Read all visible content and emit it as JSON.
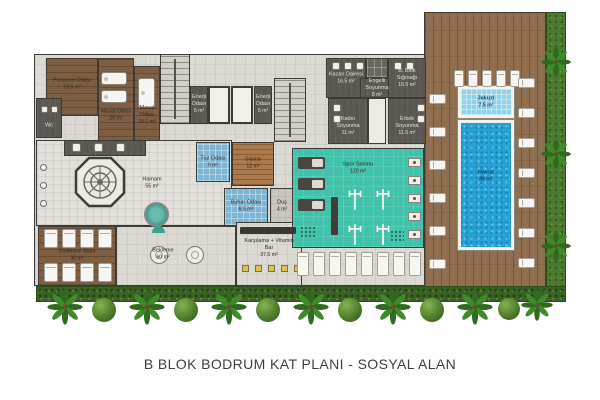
{
  "title": "B BLOK BODRUM KAT PLANI - SOSYAL ALAN",
  "colors": {
    "wall": "#3e3a36",
    "wood": "#7e5f43",
    "tile": "#dbd9d4",
    "dark_room": "#5b5752",
    "blue_room": "#7db6d4",
    "pool": "#25a2d6",
    "jacuzzi": "#93d2e8",
    "gym": "#41c2aa",
    "deck": "#8f6f4f",
    "grass": "#4b7a30",
    "hedge": "#3a6224",
    "stool_yellow": "#d7c54d"
  },
  "rooms": [
    {
      "id": "plan-base",
      "type": "tile",
      "x": 34,
      "y": 54,
      "w": 392,
      "h": 232
    },
    {
      "id": "pool-deck",
      "type": "deck",
      "x": 424,
      "y": 12,
      "w": 122,
      "h": 280
    },
    {
      "id": "side-lawn",
      "type": "grass",
      "x": 546,
      "y": 12,
      "w": 20,
      "h": 280
    },
    {
      "id": "garden-hedge",
      "type": "hedge",
      "x": 36,
      "y": 286,
      "w": 530,
      "h": 16
    },
    {
      "id": "personel-odasi",
      "type": "wood",
      "x": 46,
      "y": 58,
      "w": 52,
      "h": 58,
      "label": "Personel Odası",
      "area": "19.5 m²",
      "lx": 72,
      "ly": 84,
      "lw": 40
    },
    {
      "id": "wc",
      "type": "dark",
      "x": 36,
      "y": 98,
      "w": 26,
      "h": 40,
      "label": "Wc",
      "area": "",
      "lx": 49,
      "ly": 126,
      "lw": 18,
      "lclass": "light"
    },
    {
      "id": "masaj-odasi-1",
      "type": "wood",
      "x": 98,
      "y": 58,
      "w": 36,
      "h": 94,
      "label": "Masaj Odası",
      "area": "20 m²",
      "lx": 116,
      "ly": 115,
      "lw": 34
    },
    {
      "id": "masaj-odasi-2",
      "type": "wood",
      "x": 134,
      "y": 66,
      "w": 26,
      "h": 86,
      "label": "Masaj Odası",
      "area": "15.1 m²",
      "lx": 147,
      "ly": 115,
      "lw": 26
    },
    {
      "id": "stairwell-1",
      "type": "stairs",
      "x": 160,
      "y": 54,
      "w": 30,
      "h": 70
    },
    {
      "id": "enerji-odasi-1",
      "type": "dark",
      "x": 190,
      "y": 86,
      "w": 18,
      "h": 38,
      "label": "Enerji Odası",
      "area": "5 m²",
      "lx": 199,
      "ly": 104,
      "lw": 18,
      "lclass": "light"
    },
    {
      "id": "elevator-1",
      "type": "elevator",
      "x": 208,
      "y": 86,
      "w": 22,
      "h": 38
    },
    {
      "id": "elevator-2",
      "type": "elevator",
      "x": 231,
      "y": 86,
      "w": 22,
      "h": 38
    },
    {
      "id": "enerji-odasi-2",
      "type": "dark",
      "x": 254,
      "y": 86,
      "w": 18,
      "h": 38,
      "label": "Enerji Odası",
      "area": "5 m²",
      "lx": 263,
      "ly": 104,
      "lw": 18,
      "lclass": "light"
    },
    {
      "id": "stairwell-2",
      "type": "stairs",
      "x": 274,
      "y": 78,
      "w": 32,
      "h": 64
    },
    {
      "id": "hamam",
      "type": "hamam",
      "x": 36,
      "y": 140,
      "w": 196,
      "h": 86,
      "label": "Hamam",
      "area": "55 m²",
      "lx": 152,
      "ly": 183,
      "lw": 30
    },
    {
      "id": "hamam-nis",
      "type": "dark",
      "x": 64,
      "y": 140,
      "w": 82,
      "h": 16
    },
    {
      "id": "kazan-dairesi",
      "type": "dark",
      "x": 326,
      "y": 58,
      "w": 40,
      "h": 40,
      "label": "Kazan Dairesi",
      "area": "16.5 m²",
      "lx": 346,
      "ly": 78,
      "lw": 36,
      "lclass": "light"
    },
    {
      "id": "locker-bank",
      "type": "locker",
      "x": 366,
      "y": 58,
      "w": 22,
      "h": 20
    },
    {
      "id": "engelli-soyunma",
      "type": "dark",
      "x": 360,
      "y": 78,
      "w": 34,
      "h": 20,
      "label": "Engelli Soyunma",
      "area": "8 m²",
      "lx": 377,
      "ly": 88,
      "lw": 32,
      "lclass": "light"
    },
    {
      "id": "blok-siginagi",
      "type": "dark",
      "x": 388,
      "y": 58,
      "w": 38,
      "h": 40,
      "label": "B. Blok Sığınağı",
      "area": "16.5 m²",
      "lx": 407,
      "ly": 78,
      "lw": 36,
      "lclass": "light"
    },
    {
      "id": "soyunma-koridor",
      "type": "corridor",
      "x": 368,
      "y": 98,
      "w": 18,
      "h": 46
    },
    {
      "id": "kadin-soyunma",
      "type": "dark",
      "x": 328,
      "y": 98,
      "w": 40,
      "h": 46,
      "label": "Kadın Soyunma",
      "area": "11 m²",
      "lx": 348,
      "ly": 126,
      "lw": 30,
      "lclass": "light"
    },
    {
      "id": "erkek-soyunma",
      "type": "dark",
      "x": 388,
      "y": 98,
      "w": 38,
      "h": 46,
      "label": "Erkek Soyunma",
      "area": "11.5 m²",
      "lx": 407,
      "ly": 126,
      "lw": 30,
      "lclass": "light"
    },
    {
      "id": "tuz-odasi",
      "type": "blue",
      "x": 196,
      "y": 142,
      "w": 34,
      "h": 40,
      "label": "Tuz Odası",
      "area": "9 m²",
      "lx": 213,
      "ly": 162,
      "lw": 30
    },
    {
      "id": "sauna",
      "type": "sauna",
      "x": 232,
      "y": 142,
      "w": 42,
      "h": 44,
      "label": "Sauna",
      "area": "12 m²",
      "lx": 253,
      "ly": 163,
      "lw": 30
    },
    {
      "id": "buhar-odasi",
      "type": "blue",
      "x": 224,
      "y": 188,
      "w": 44,
      "h": 38,
      "label": "Buhar Odası",
      "area": "6.5 m²",
      "lx": 246,
      "ly": 206,
      "lw": 34
    },
    {
      "id": "dus",
      "type": "tile2",
      "x": 270,
      "y": 188,
      "w": 24,
      "h": 38,
      "label": "Duş",
      "area": "4 m²",
      "lx": 282,
      "ly": 206,
      "lw": 20
    },
    {
      "id": "dinlenme-alani",
      "type": "wood",
      "x": 38,
      "y": 226,
      "w": 78,
      "h": 60,
      "label": "Dinlenme Alanı",
      "area": "30 m²",
      "lx": 77,
      "ly": 255,
      "lw": 42
    },
    {
      "id": "bekleme",
      "type": "tile",
      "x": 116,
      "y": 226,
      "w": 120,
      "h": 60,
      "label": "Bekleme",
      "area": "60 m²",
      "lx": 163,
      "ly": 254,
      "lw": 36
    },
    {
      "id": "karsilama-vitamin-bar",
      "type": "tile",
      "x": 236,
      "y": 222,
      "w": 66,
      "h": 64,
      "label": "Karşılama + Vitamin Bar",
      "area": "37.5 m²",
      "lx": 269,
      "ly": 248,
      "lw": 56
    },
    {
      "id": "spor-salonu",
      "type": "gym",
      "x": 292,
      "y": 148,
      "w": 132,
      "h": 100,
      "label": "Spor Salonu",
      "area": "120 m²",
      "lx": 358,
      "ly": 168,
      "lw": 40
    },
    {
      "id": "jakuzi",
      "type": "jacuzzi",
      "x": 458,
      "y": 86,
      "w": 56,
      "h": 32,
      "label": "Jakuzi",
      "area": "7.5 m²",
      "lx": 486,
      "ly": 102,
      "lw": 30,
      "lclass": "pool-text"
    },
    {
      "id": "havuz",
      "type": "pool",
      "x": 458,
      "y": 120,
      "w": 56,
      "h": 130,
      "label": "Havuz",
      "area": "86 m²",
      "lx": 486,
      "ly": 176,
      "lw": 30,
      "lclass": "pool-text"
    }
  ],
  "furniture": [
    {
      "icon": "massage-table-icon",
      "x": 101,
      "y": 72,
      "w": 26,
      "h": 13
    },
    {
      "icon": "massage-table-icon",
      "x": 101,
      "y": 90,
      "w": 26,
      "h": 13
    },
    {
      "icon": "massage-table-icon",
      "x": 138,
      "y": 78,
      "w": 17,
      "h": 30
    },
    {
      "icon": "fixture-icon",
      "x": 41,
      "y": 106,
      "w": 7,
      "h": 7
    },
    {
      "icon": "fixture-icon",
      "x": 51,
      "y": 106,
      "w": 7,
      "h": 7
    },
    {
      "icon": "fixture-icon",
      "x": 72,
      "y": 143,
      "w": 9,
      "h": 9
    },
    {
      "icon": "fixture-icon",
      "x": 94,
      "y": 143,
      "w": 9,
      "h": 9
    },
    {
      "icon": "fixture-icon",
      "x": 116,
      "y": 143,
      "w": 9,
      "h": 9
    },
    {
      "icon": "kurna-icon",
      "x": 40,
      "y": 164,
      "w": 7,
      "h": 7
    },
    {
      "icon": "kurna-icon",
      "x": 40,
      "y": 182,
      "w": 7,
      "h": 7
    },
    {
      "icon": "kurna-icon",
      "x": 40,
      "y": 200,
      "w": 7,
      "h": 7
    },
    {
      "icon": "gobektasi-icon",
      "x": 74,
      "y": 156,
      "w": 52,
      "h": 52
    },
    {
      "icon": "hamam-jacuzzi-icon",
      "x": 144,
      "y": 202,
      "w": 25,
      "h": 25
    },
    {
      "icon": "fixture-icon",
      "x": 332,
      "y": 62,
      "w": 8,
      "h": 8
    },
    {
      "icon": "fixture-icon",
      "x": 344,
      "y": 62,
      "w": 8,
      "h": 8
    },
    {
      "icon": "fixture-icon",
      "x": 356,
      "y": 62,
      "w": 8,
      "h": 8
    },
    {
      "icon": "fixture-icon",
      "x": 394,
      "y": 62,
      "w": 8,
      "h": 8
    },
    {
      "icon": "fixture-icon",
      "x": 406,
      "y": 62,
      "w": 8,
      "h": 8
    },
    {
      "icon": "fixture-icon",
      "x": 333,
      "y": 104,
      "w": 8,
      "h": 8
    },
    {
      "icon": "fixture-icon",
      "x": 333,
      "y": 115,
      "w": 8,
      "h": 8
    },
    {
      "icon": "fixture-icon",
      "x": 417,
      "y": 104,
      "w": 8,
      "h": 8
    },
    {
      "icon": "fixture-icon",
      "x": 417,
      "y": 115,
      "w": 8,
      "h": 8
    },
    {
      "icon": "lounger-icon",
      "x": 44,
      "y": 229,
      "w": 14,
      "h": 19
    },
    {
      "icon": "lounger-icon",
      "x": 62,
      "y": 229,
      "w": 14,
      "h": 19
    },
    {
      "icon": "lounger-icon",
      "x": 80,
      "y": 229,
      "w": 14,
      "h": 19
    },
    {
      "icon": "lounger-icon",
      "x": 98,
      "y": 229,
      "w": 14,
      "h": 19
    },
    {
      "icon": "lounger-icon",
      "x": 44,
      "y": 263,
      "w": 14,
      "h": 19
    },
    {
      "icon": "lounger-icon",
      "x": 62,
      "y": 263,
      "w": 14,
      "h": 19
    },
    {
      "icon": "lounger-icon",
      "x": 80,
      "y": 263,
      "w": 14,
      "h": 19
    },
    {
      "icon": "lounger-icon",
      "x": 98,
      "y": 263,
      "w": 14,
      "h": 19
    },
    {
      "icon": "plant-icon",
      "x": 152,
      "y": 226,
      "w": 13,
      "h": 7
    },
    {
      "icon": "round-table-icon",
      "x": 150,
      "y": 246,
      "w": 18,
      "h": 18
    },
    {
      "icon": "round-table-icon",
      "x": 186,
      "y": 246,
      "w": 18,
      "h": 18
    },
    {
      "icon": "bar-counter-icon",
      "x": 240,
      "y": 227,
      "w": 56,
      "h": 7
    },
    {
      "icon": "bar-stool-icon",
      "x": 242,
      "y": 265,
      "w": 7,
      "h": 7
    },
    {
      "icon": "bar-stool-icon",
      "x": 255,
      "y": 265,
      "w": 7,
      "h": 7
    },
    {
      "icon": "bar-stool-icon",
      "x": 268,
      "y": 265,
      "w": 7,
      "h": 7
    },
    {
      "icon": "bar-stool-icon",
      "x": 281,
      "y": 265,
      "w": 7,
      "h": 7
    },
    {
      "icon": "bar-stool-icon",
      "x": 294,
      "y": 265,
      "w": 7,
      "h": 7
    },
    {
      "icon": "treadmill-icon",
      "x": 298,
      "y": 157,
      "w": 27,
      "h": 12
    },
    {
      "icon": "treadmill-icon",
      "x": 298,
      "y": 178,
      "w": 27,
      "h": 12
    },
    {
      "icon": "treadmill-icon",
      "x": 298,
      "y": 199,
      "w": 27,
      "h": 12
    },
    {
      "icon": "rack-icon",
      "x": 331,
      "y": 197,
      "w": 7,
      "h": 38
    },
    {
      "icon": "barbell-icon",
      "x": 347,
      "y": 186,
      "w": 16,
      "h": 27
    },
    {
      "icon": "barbell-icon",
      "x": 375,
      "y": 186,
      "w": 16,
      "h": 27
    },
    {
      "icon": "barbell-icon",
      "x": 347,
      "y": 221,
      "w": 16,
      "h": 27
    },
    {
      "icon": "barbell-icon",
      "x": 375,
      "y": 221,
      "w": 16,
      "h": 27
    },
    {
      "icon": "machine-icon",
      "x": 408,
      "y": 158,
      "w": 13,
      "h": 9
    },
    {
      "icon": "machine-icon",
      "x": 408,
      "y": 176,
      "w": 13,
      "h": 9
    },
    {
      "icon": "machine-icon",
      "x": 408,
      "y": 194,
      "w": 13,
      "h": 9
    },
    {
      "icon": "machine-icon",
      "x": 408,
      "y": 212,
      "w": 13,
      "h": 9
    },
    {
      "icon": "machine-icon",
      "x": 408,
      "y": 230,
      "w": 13,
      "h": 9
    },
    {
      "icon": "mat-icon",
      "x": 300,
      "y": 226,
      "w": 16,
      "h": 13
    },
    {
      "icon": "mat-icon",
      "x": 390,
      "y": 230,
      "w": 14,
      "h": 11
    },
    {
      "icon": "lounger-icon",
      "x": 297,
      "y": 252,
      "w": 12,
      "h": 24
    },
    {
      "icon": "lounger-icon",
      "x": 313,
      "y": 252,
      "w": 12,
      "h": 24
    },
    {
      "icon": "lounger-icon",
      "x": 329,
      "y": 252,
      "w": 12,
      "h": 24
    },
    {
      "icon": "lounger-icon",
      "x": 345,
      "y": 252,
      "w": 12,
      "h": 24
    },
    {
      "icon": "lounger-icon",
      "x": 361,
      "y": 252,
      "w": 12,
      "h": 24
    },
    {
      "icon": "lounger-icon",
      "x": 377,
      "y": 252,
      "w": 12,
      "h": 24
    },
    {
      "icon": "lounger-icon",
      "x": 393,
      "y": 252,
      "w": 12,
      "h": 24
    },
    {
      "icon": "lounger-icon",
      "x": 409,
      "y": 252,
      "w": 12,
      "h": 24
    },
    {
      "icon": "lounger-icon",
      "x": 454,
      "y": 70,
      "w": 10,
      "h": 17
    },
    {
      "icon": "lounger-icon",
      "x": 468,
      "y": 70,
      "w": 10,
      "h": 17
    },
    {
      "icon": "lounger-icon",
      "x": 482,
      "y": 70,
      "w": 10,
      "h": 17
    },
    {
      "icon": "lounger-icon",
      "x": 496,
      "y": 70,
      "w": 10,
      "h": 17
    },
    {
      "icon": "lounger-icon",
      "x": 510,
      "y": 70,
      "w": 10,
      "h": 17
    },
    {
      "icon": "lounger-h-icon",
      "x": 429,
      "y": 94,
      "w": 17,
      "h": 10
    },
    {
      "icon": "lounger-h-icon",
      "x": 429,
      "y": 127,
      "w": 17,
      "h": 10
    },
    {
      "icon": "lounger-h-icon",
      "x": 429,
      "y": 160,
      "w": 17,
      "h": 10
    },
    {
      "icon": "lounger-h-icon",
      "x": 429,
      "y": 193,
      "w": 17,
      "h": 10
    },
    {
      "icon": "lounger-h-icon",
      "x": 429,
      "y": 226,
      "w": 17,
      "h": 10
    },
    {
      "icon": "lounger-h-icon",
      "x": 429,
      "y": 259,
      "w": 17,
      "h": 10
    },
    {
      "icon": "lounger-h-icon",
      "x": 518,
      "y": 78,
      "w": 17,
      "h": 10
    },
    {
      "icon": "lounger-h-icon",
      "x": 518,
      "y": 108,
      "w": 17,
      "h": 10
    },
    {
      "icon": "lounger-h-icon",
      "x": 518,
      "y": 138,
      "w": 17,
      "h": 10
    },
    {
      "icon": "lounger-h-icon",
      "x": 518,
      "y": 168,
      "w": 17,
      "h": 10
    },
    {
      "icon": "lounger-h-icon",
      "x": 518,
      "y": 198,
      "w": 17,
      "h": 10
    },
    {
      "icon": "lounger-h-icon",
      "x": 518,
      "y": 228,
      "w": 17,
      "h": 10
    },
    {
      "icon": "lounger-h-icon",
      "x": 518,
      "y": 258,
      "w": 17,
      "h": 10
    },
    {
      "icon": "palm-tree-icon",
      "x": 540,
      "y": 46,
      "w": 32,
      "h": 32
    },
    {
      "icon": "palm-tree-icon",
      "x": 540,
      "y": 138,
      "w": 32,
      "h": 32
    },
    {
      "icon": "palm-tree-icon",
      "x": 540,
      "y": 230,
      "w": 32,
      "h": 32
    },
    {
      "icon": "palm-tree-icon",
      "x": 46,
      "y": 288,
      "w": 38,
      "h": 38
    },
    {
      "icon": "palm-tree-icon",
      "x": 128,
      "y": 288,
      "w": 38,
      "h": 38
    },
    {
      "icon": "palm-tree-icon",
      "x": 210,
      "y": 288,
      "w": 38,
      "h": 38
    },
    {
      "icon": "palm-tree-icon",
      "x": 292,
      "y": 288,
      "w": 38,
      "h": 38
    },
    {
      "icon": "palm-tree-icon",
      "x": 374,
      "y": 288,
      "w": 38,
      "h": 38
    },
    {
      "icon": "palm-tree-icon",
      "x": 456,
      "y": 288,
      "w": 38,
      "h": 38
    },
    {
      "icon": "palm-tree-icon",
      "x": 520,
      "y": 288,
      "w": 34,
      "h": 34
    },
    {
      "icon": "bush-icon",
      "x": 92,
      "y": 298,
      "w": 24,
      "h": 24
    },
    {
      "icon": "bush-icon",
      "x": 174,
      "y": 298,
      "w": 24,
      "h": 24
    },
    {
      "icon": "bush-icon",
      "x": 256,
      "y": 298,
      "w": 24,
      "h": 24
    },
    {
      "icon": "bush-icon",
      "x": 338,
      "y": 298,
      "w": 24,
      "h": 24
    },
    {
      "icon": "bush-icon",
      "x": 420,
      "y": 298,
      "w": 24,
      "h": 24
    },
    {
      "icon": "bush-icon",
      "x": 498,
      "y": 298,
      "w": 22,
      "h": 22
    }
  ]
}
